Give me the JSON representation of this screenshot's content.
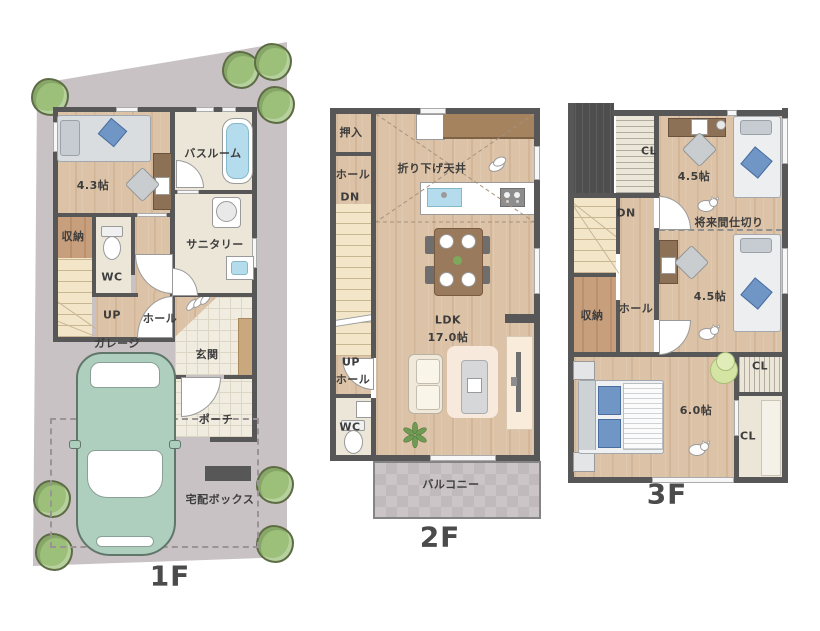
{
  "floors": {
    "f1": {
      "name": "1F",
      "rooms": {
        "bedroom_size": "4.3帖",
        "bathroom": "バスルーム",
        "storage": "収納",
        "sanitary": "サニタリー",
        "wc": "WC",
        "up": "UP",
        "hall": "ホール",
        "garage": "ガレージ",
        "entrance": "玄関",
        "porch": "ポーチ",
        "delivery_box": "宅配ボックス"
      }
    },
    "f2": {
      "name": "2F",
      "rooms": {
        "oshiire": "押入",
        "hall": "ホール",
        "dn": "DN",
        "lowered_ceiling": "折り下げ天井",
        "ldk": "LDK",
        "ldk_size": "17.0帖",
        "up": "UP",
        "up_hall": "ホール",
        "wc": "WC",
        "balcony": "バルコニー"
      }
    },
    "f3": {
      "name": "3F",
      "rooms": {
        "cl_top": "CL",
        "room_a_size": "4.5帖",
        "dn": "DN",
        "future_partition": "将来間仕切り",
        "storage": "収納",
        "hall": "ホール",
        "room_b_size": "4.5帖",
        "bedroom_size": "6.0帖",
        "cl_upper_right": "CL",
        "cl_lower_right": "CL"
      }
    }
  },
  "colors": {
    "site": "#c9c2c4",
    "wall": "#575757",
    "wood_floor": "#dcc2a6",
    "wood_dark": "#c79f7d",
    "beige_floor": "#ebe6d8",
    "entrance_tile": "#f1ece0",
    "stairs": "#f3e5c7",
    "balcony": "#ccc5c7",
    "bath_water": "#b5dcec",
    "car_body": "#aecfbe",
    "tree": "#9cbf79",
    "bed_gray": "#dadde0",
    "pillow_blue": "#6f96c4",
    "desk_brown": "#8d7156",
    "table_brown": "#9a7a5c",
    "sofa_cream": "#f0e9da",
    "rug": "#f7e9dc",
    "stool_green": "#d3e4a3",
    "label_text": "#3d3d3d"
  }
}
